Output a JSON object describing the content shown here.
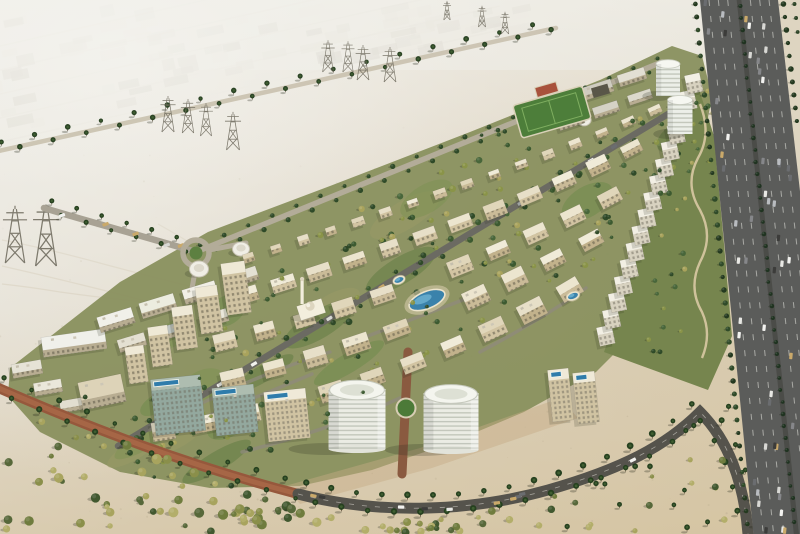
{
  "scene": {
    "type": "aerial-architectural-rendering",
    "label": "Aerial rendering of a master-planned desert residential community beside a multi-lane highway",
    "palette": {
      "sand_light": "#e8e6de",
      "sand": "#dcd2bf",
      "sand_warm": "#d7c8a9",
      "haze": "#f2f1ec",
      "asphalt": "#5b5c5a",
      "asphalt_dark": "#4b4c48",
      "brick_road": "#96583c",
      "brick_road_light": "#aa6a48",
      "inner_road": "#6b6a62",
      "service_road": "#b3ac99",
      "lawn": "#5d8041",
      "green_dark": "#2f4a28",
      "green_mid": "#3c5a30",
      "green_olive": "#8a9448",
      "green_yellow": "#a9a35c",
      "park_green": "#76854e",
      "dev_ground": "#89905e",
      "roof_white": "#f2efe4",
      "roof_beige": "#e7dfc8",
      "facade_beige": "#cabb98",
      "glass": "#9fb0a4",
      "pool_blue": "#3a82ab",
      "pool_light": "#6fb3d2",
      "dome": "#ddd5bf",
      "pylon": "#6b675a",
      "tree_shadow": "#23281a",
      "path_tan": "#d9c9a4",
      "field_green": "#4d7e3a",
      "court_red": "#a8523c",
      "car_colors": [
        "#f2f2ef",
        "#e8e8e4",
        "#d8d8d4",
        "#3c3c3a",
        "#86878a",
        "#b9bcc0",
        "#6b6d70",
        "#caa96a"
      ]
    },
    "features": {
      "transmission_tower_count": 13,
      "drum_building_count": 2,
      "water_tank_count": 3,
      "roundabout_count": 1,
      "mosque_count": 1,
      "sports_field_count": 1,
      "highway_carriageways": 2
    }
  }
}
